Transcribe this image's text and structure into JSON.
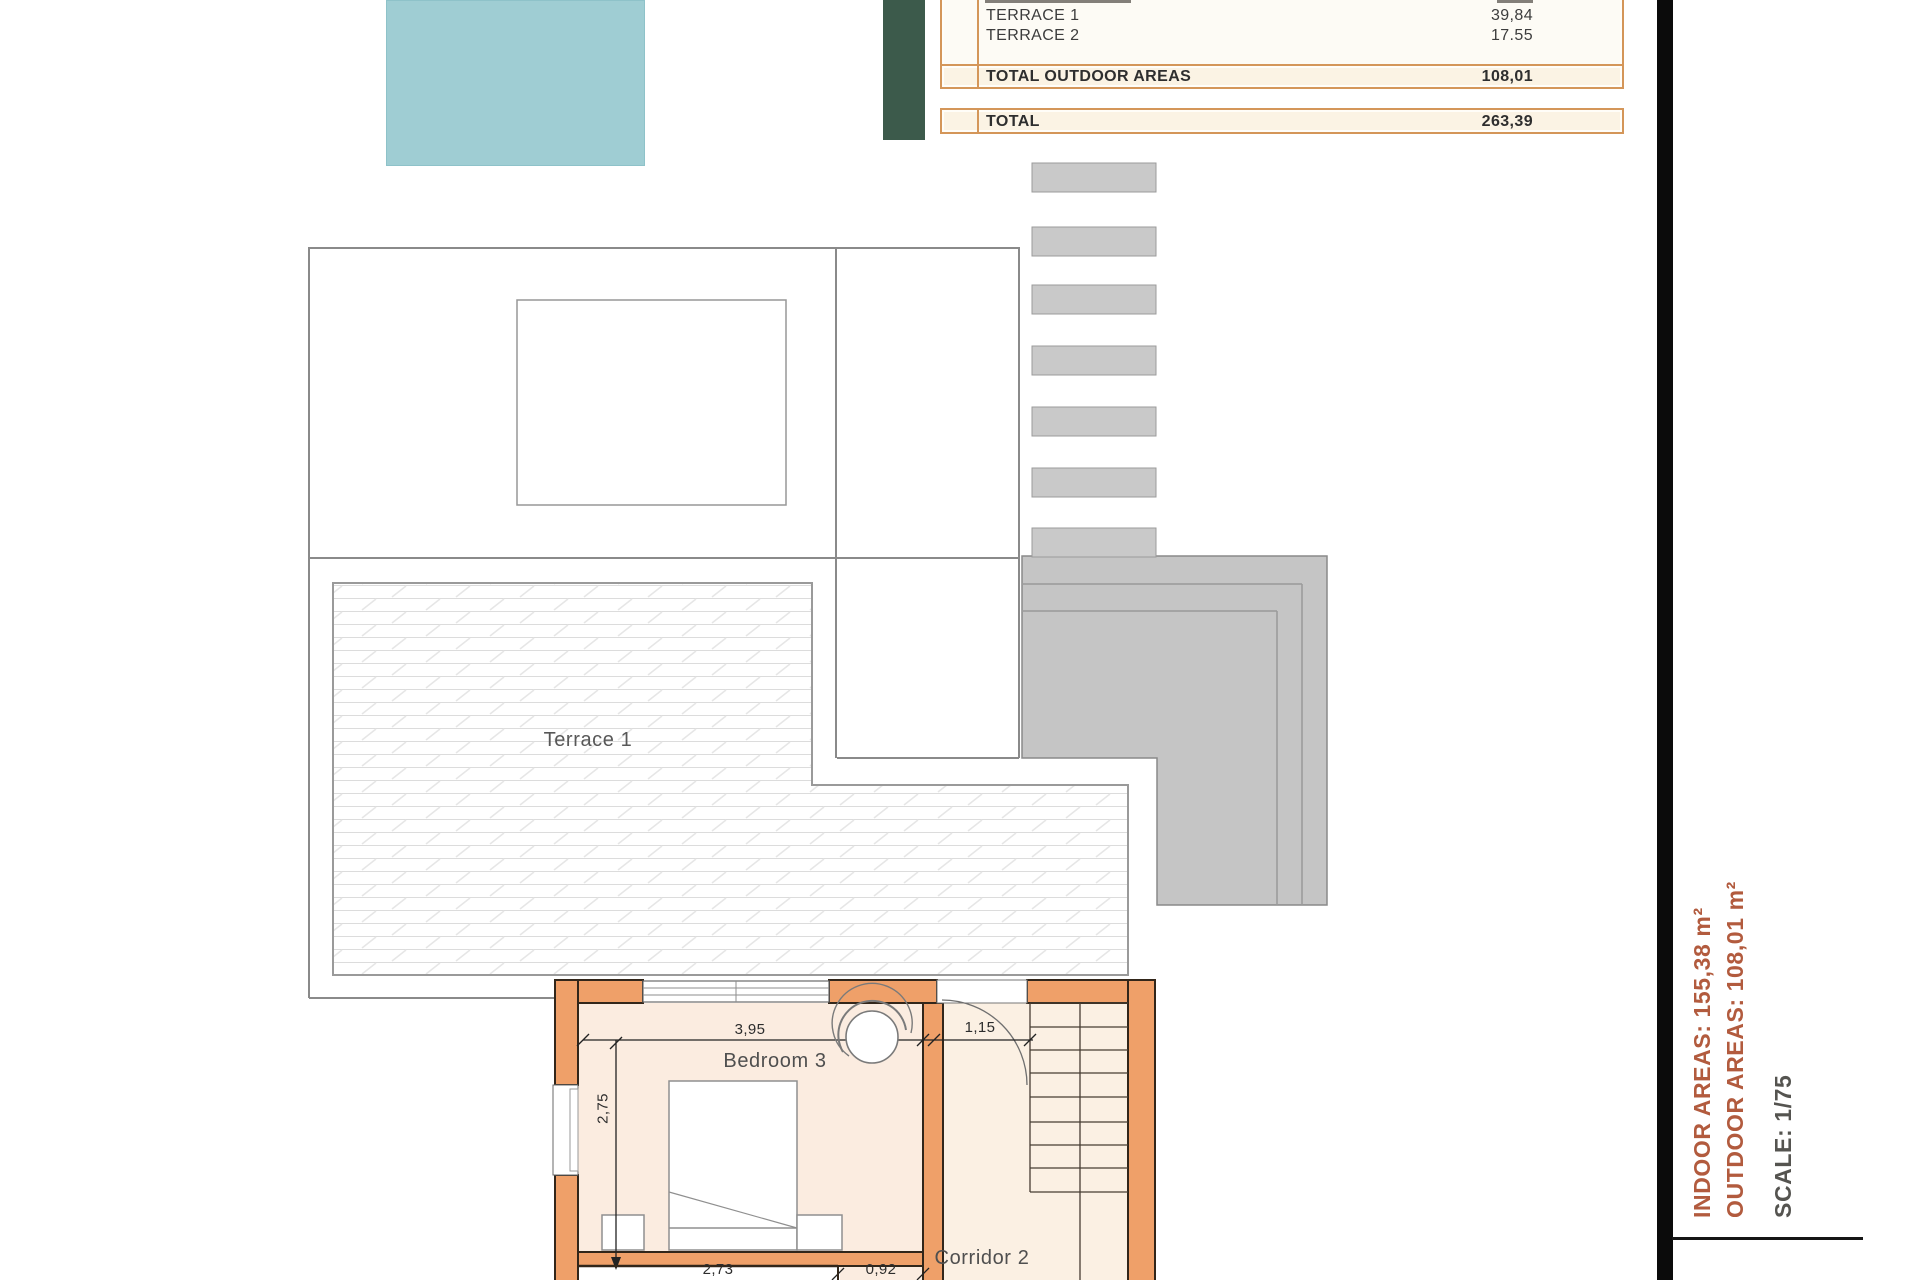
{
  "table": {
    "rows": [
      {
        "label": "TERRACE 1",
        "value": "39,84"
      },
      {
        "label": "TERRACE 2",
        "value": "17.55"
      }
    ],
    "total_outdoor": {
      "label": "TOTAL OUTDOOR AREAS",
      "value": "108,01"
    },
    "total": {
      "label": "TOTAL",
      "value": "263,39"
    }
  },
  "plan": {
    "terrace_label": "Terrace 1",
    "bedroom_label": "Bedroom 3",
    "corridor_label": "Corridor 2",
    "dim_bedroom_width": "3,95",
    "dim_door_width": "1,15",
    "dim_bedroom_depth": "2,75",
    "dim_bottom_room_width": "2,73",
    "dim_bottom_opening": "0,92"
  },
  "sidebar": {
    "indoor": "INDOOR AREAS: 155,38 m²",
    "outdoor": "OUTDOOR AREAS: 108,01 m²",
    "scale": "SCALE: 1/75"
  },
  "colors": {
    "pool": "#9fcdd3",
    "green_bar": "#3c5a4b",
    "table_border": "#d49659",
    "wall_orange": "#efa069",
    "wall_light_orange": "#f4c094",
    "room_fill": "#fbece0",
    "stair_fill": "#fbf0e3",
    "gray_roof": "#c5c5c5",
    "side_text_rust": "#b25b3e"
  }
}
